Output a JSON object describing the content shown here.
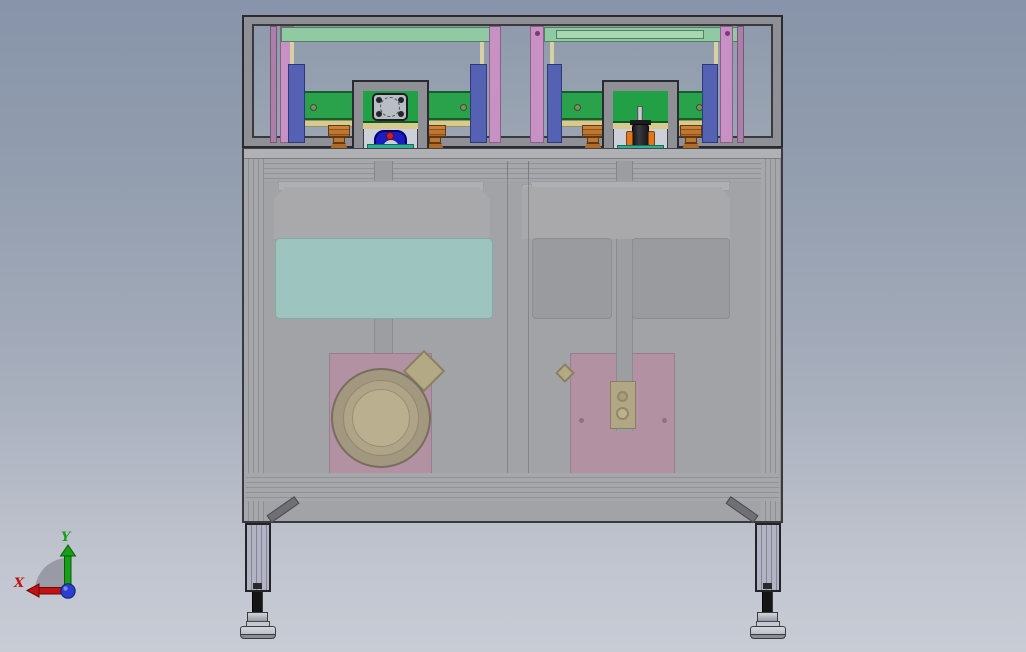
{
  "viewport": {
    "axis_triad": {
      "x_label": "X",
      "y_label": "Y",
      "x_axis_color": "#c01212",
      "y_axis_color": "#17a017",
      "origin_color": "#2a3fd0"
    },
    "colors": {
      "background_top": "#8794a9",
      "background_bottom": "#c8ccd5",
      "frame_gray": "#8e9096",
      "frame_outline": "#2b2b2f",
      "top_bar_green": "#8fcaa2",
      "conveyor_green": "#2aa24b",
      "pink_panel": "#c791c4",
      "blue_column": "#5562b4",
      "tan_rail": "#d6ca8e",
      "orange_clamp": "#c0762f",
      "bearing_blue": "#1c1cc0",
      "indicator_red": "#cc2222",
      "teal_mount": "#2fae96",
      "motor_black": "#222226",
      "motor_orange": "#e0781a",
      "cabinet_gray": "#a2a3a6",
      "tank_teal": "#9bcdc5",
      "hopper_gray": "#ababae",
      "plate_pink": "#b68da1",
      "bowl_tan": "#c0b288",
      "leg_gray": "#b2b5c1"
    }
  }
}
